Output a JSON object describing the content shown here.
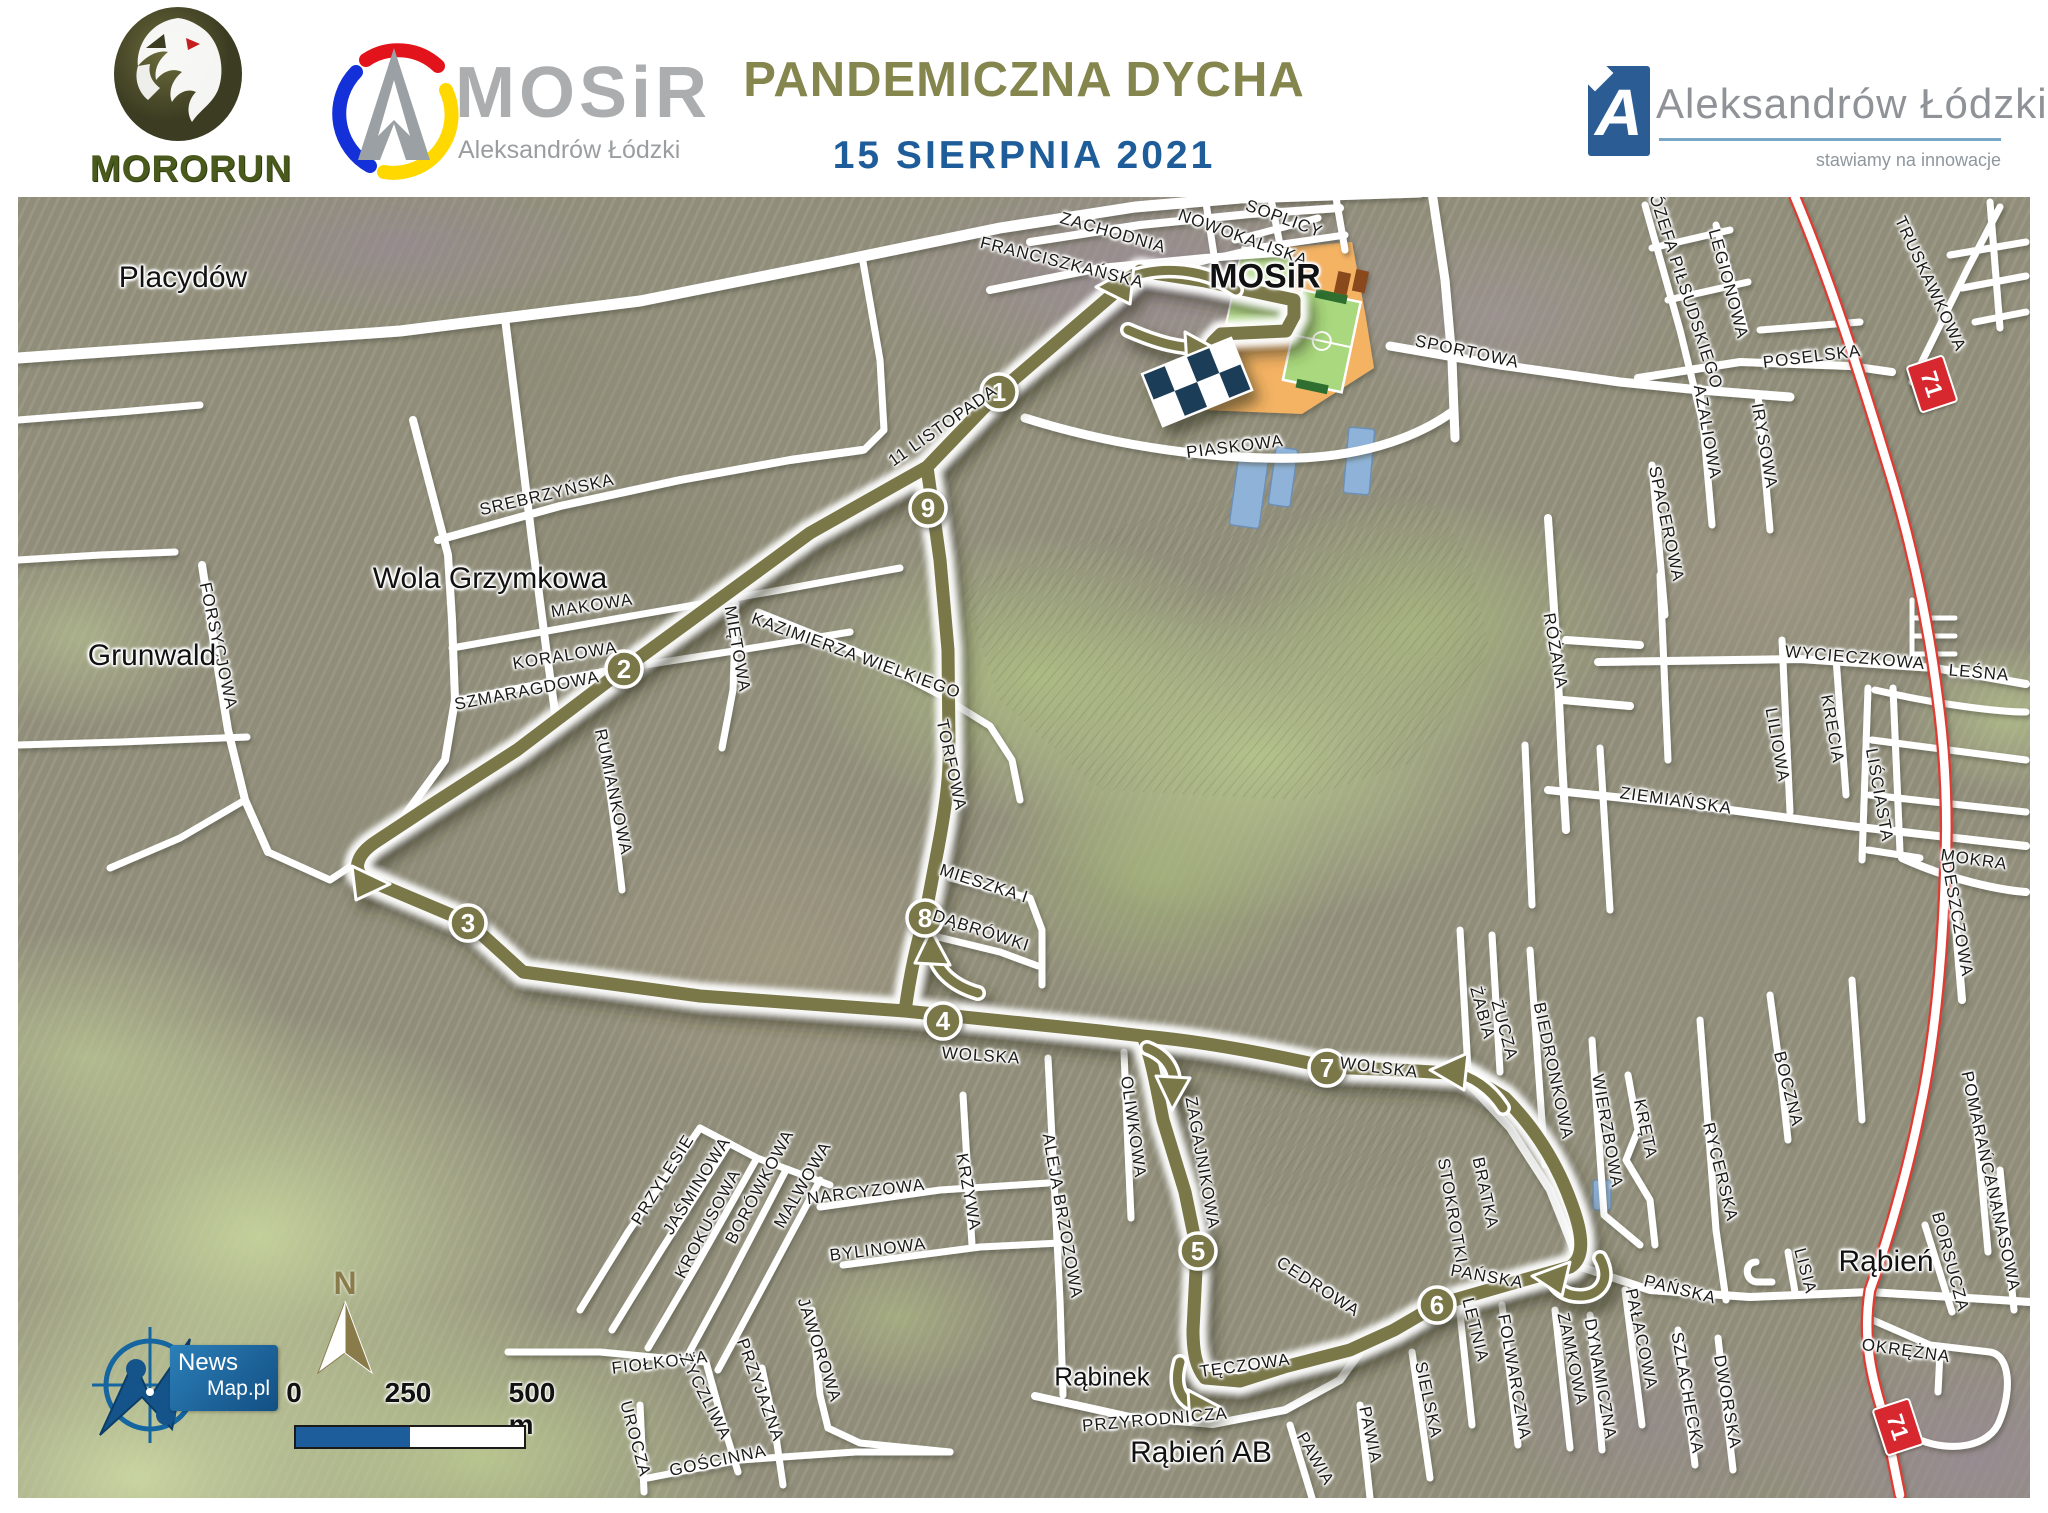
{
  "header": {
    "title": "PANDEMICZNA DYCHA",
    "date": "15 SIERPNIA 2021",
    "mororun_name": "MORORUN",
    "mosir_name": "MOSiR",
    "mosir_subtitle": "Aleksandrów Łódzki",
    "city_name": "Aleksandrów Łódzki",
    "city_tagline": "stawiamy na innowacje"
  },
  "map": {
    "places": [
      {
        "text": "Placydów",
        "x": 183,
        "y": 278,
        "s": 30
      },
      {
        "text": "Wola Grzymkowa",
        "x": 490,
        "y": 579,
        "s": 30
      },
      {
        "text": "Grunwald",
        "x": 152,
        "y": 656,
        "s": 30
      },
      {
        "text": "MOSiR",
        "x": 1265,
        "y": 277,
        "s": 34,
        "b": 1
      },
      {
        "text": "Rąbień",
        "x": 1886,
        "y": 1262,
        "s": 30
      },
      {
        "text": "Rąbinek",
        "x": 1102,
        "y": 1377,
        "s": 26
      },
      {
        "text": "Rąbień AB",
        "x": 1201,
        "y": 1453,
        "s": 30
      }
    ],
    "streets": [
      {
        "text": "ZACHODNIA",
        "x": 1113,
        "y": 233,
        "r": 16
      },
      {
        "text": "FRANCISZKAŃSKA",
        "x": 1062,
        "y": 263,
        "r": 14
      },
      {
        "text": "SOPLICY",
        "x": 1284,
        "y": 219,
        "r": 20
      },
      {
        "text": "NOWOKALISKA",
        "x": 1243,
        "y": 238,
        "r": 20
      },
      {
        "text": "SPORTOWA",
        "x": 1467,
        "y": 352,
        "r": 12
      },
      {
        "text": "PIASKOWA",
        "x": 1235,
        "y": 447,
        "r": -7
      },
      {
        "text": "11 LISTOPADA",
        "x": 943,
        "y": 426,
        "r": -35
      },
      {
        "text": "SREBRZYŃSKA",
        "x": 547,
        "y": 495,
        "r": -13
      },
      {
        "text": "MAKOWA",
        "x": 592,
        "y": 606,
        "r": -9
      },
      {
        "text": "KORALOWA",
        "x": 565,
        "y": 656,
        "r": -9
      },
      {
        "text": "SZMARAGDOWA",
        "x": 527,
        "y": 691,
        "r": -11
      },
      {
        "text": "MIĘTOWA",
        "x": 737,
        "y": 649,
        "r": 80
      },
      {
        "text": "KAZIMIERZA WIELKIEGO",
        "x": 856,
        "y": 656,
        "r": 20
      },
      {
        "text": "RUMIANKOWA",
        "x": 613,
        "y": 792,
        "r": 78
      },
      {
        "text": "FORSYCJOWA",
        "x": 218,
        "y": 646,
        "r": 78
      },
      {
        "text": "TORFOWA",
        "x": 951,
        "y": 765,
        "r": 78
      },
      {
        "text": "MIESZKA I",
        "x": 984,
        "y": 884,
        "r": 18
      },
      {
        "text": "DĄBRÓWKI",
        "x": 981,
        "y": 931,
        "r": 18
      },
      {
        "text": "WOLSKA",
        "x": 981,
        "y": 1056,
        "r": 4
      },
      {
        "text": "WOLSKA",
        "x": 1379,
        "y": 1068,
        "r": 7
      },
      {
        "text": "OLIWKOWA",
        "x": 1133,
        "y": 1127,
        "r": 82
      },
      {
        "text": "ZAGAJNIKOWA",
        "x": 1202,
        "y": 1163,
        "r": 80
      },
      {
        "text": "ALEJA BRZOZOWA",
        "x": 1062,
        "y": 1216,
        "r": 80
      },
      {
        "text": "CEDROWA",
        "x": 1318,
        "y": 1287,
        "r": 33
      },
      {
        "text": "STOKROTKI",
        "x": 1452,
        "y": 1211,
        "r": 80
      },
      {
        "text": "BRATKA",
        "x": 1485,
        "y": 1193,
        "r": 78
      },
      {
        "text": "ŻABIA",
        "x": 1482,
        "y": 1013,
        "r": 75
      },
      {
        "text": "ŻUCZA",
        "x": 1504,
        "y": 1030,
        "r": 75
      },
      {
        "text": "BIEDRONKOWA",
        "x": 1553,
        "y": 1071,
        "r": 78
      },
      {
        "text": "WIERZBOWA",
        "x": 1607,
        "y": 1131,
        "r": 80
      },
      {
        "text": "KRĘTA",
        "x": 1645,
        "y": 1129,
        "r": 78
      },
      {
        "text": "RYCERSKA",
        "x": 1720,
        "y": 1172,
        "r": 76
      },
      {
        "text": "BOCZNA",
        "x": 1788,
        "y": 1089,
        "r": 76
      },
      {
        "text": "LISIA",
        "x": 1805,
        "y": 1271,
        "r": 75
      },
      {
        "text": "PAŃSKA",
        "x": 1487,
        "y": 1277,
        "r": 10
      },
      {
        "text": "PAŃSKA",
        "x": 1680,
        "y": 1290,
        "r": 14
      },
      {
        "text": "LETNIA",
        "x": 1475,
        "y": 1330,
        "r": 76
      },
      {
        "text": "FOLWARCZNA",
        "x": 1514,
        "y": 1377,
        "r": 80
      },
      {
        "text": "ZAMKOWA",
        "x": 1572,
        "y": 1359,
        "r": 78
      },
      {
        "text": "DYNAMICZNA",
        "x": 1600,
        "y": 1379,
        "r": 80
      },
      {
        "text": "PAŁACOWA",
        "x": 1641,
        "y": 1339,
        "r": 78
      },
      {
        "text": "SZLACHECKA",
        "x": 1687,
        "y": 1393,
        "r": 80
      },
      {
        "text": "DWORSKA",
        "x": 1727,
        "y": 1402,
        "r": 80
      },
      {
        "text": "PRZYLESIE",
        "x": 663,
        "y": 1180,
        "r": -58
      },
      {
        "text": "JAŚMINOWA",
        "x": 697,
        "y": 1186,
        "r": -58
      },
      {
        "text": "KROKUSOWA",
        "x": 708,
        "y": 1224,
        "r": -62
      },
      {
        "text": "BORÓWKOWA",
        "x": 760,
        "y": 1187,
        "r": -62
      },
      {
        "text": "MALWOWA",
        "x": 803,
        "y": 1185,
        "r": -60
      },
      {
        "text": "NARCYZOWA",
        "x": 866,
        "y": 1192,
        "r": -7
      },
      {
        "text": "BYLINOWA",
        "x": 878,
        "y": 1250,
        "r": -7
      },
      {
        "text": "KRZYWA",
        "x": 968,
        "y": 1192,
        "r": 80
      },
      {
        "text": "JAWOROWA",
        "x": 819,
        "y": 1350,
        "r": 72
      },
      {
        "text": "FIOŁKOWA",
        "x": 660,
        "y": 1363,
        "r": -7
      },
      {
        "text": "ŻYCZLIWA",
        "x": 705,
        "y": 1397,
        "r": 63
      },
      {
        "text": "PRZYJAZNA",
        "x": 760,
        "y": 1390,
        "r": 70
      },
      {
        "text": "UROCZA",
        "x": 635,
        "y": 1439,
        "r": 75
      },
      {
        "text": "GOŚCINNA",
        "x": 718,
        "y": 1461,
        "r": -12
      },
      {
        "text": "PRZYRODNICZA",
        "x": 1155,
        "y": 1420,
        "r": -5
      },
      {
        "text": "TĘCZOWA",
        "x": 1245,
        "y": 1366,
        "r": -8
      },
      {
        "text": "PAWIA",
        "x": 1315,
        "y": 1459,
        "r": 60
      },
      {
        "text": "PAWIA",
        "x": 1370,
        "y": 1435,
        "r": 78
      },
      {
        "text": "SIELSKA",
        "x": 1428,
        "y": 1400,
        "r": 78
      },
      {
        "text": "ZIEMIAŃSKA",
        "x": 1676,
        "y": 801,
        "r": 8
      },
      {
        "text": "LILIOWA",
        "x": 1777,
        "y": 745,
        "r": 80
      },
      {
        "text": "KRECIA",
        "x": 1832,
        "y": 729,
        "r": 80
      },
      {
        "text": "LIŚCIASTA",
        "x": 1879,
        "y": 795,
        "r": 80
      },
      {
        "text": "WYCIECZKOWA",
        "x": 1855,
        "y": 658,
        "r": 5
      },
      {
        "text": "LEŚNA",
        "x": 1979,
        "y": 673,
        "r": 5
      },
      {
        "text": "MOKRA",
        "x": 1974,
        "y": 860,
        "r": 8
      },
      {
        "text": "DESZCZOWA",
        "x": 1957,
        "y": 919,
        "r": 80
      },
      {
        "text": "RÓŻANA",
        "x": 1555,
        "y": 651,
        "r": 80
      },
      {
        "text": "JÓZEFA PIŁSUDSKIEGO",
        "x": 1684,
        "y": 287,
        "r": 72
      },
      {
        "text": "LEGIONOWA",
        "x": 1728,
        "y": 284,
        "r": 75
      },
      {
        "text": "POSELSKA",
        "x": 1812,
        "y": 357,
        "r": -7
      },
      {
        "text": "AZALIOWA",
        "x": 1707,
        "y": 432,
        "r": 80
      },
      {
        "text": "IRYSOWA",
        "x": 1764,
        "y": 446,
        "r": 80
      },
      {
        "text": "SPACEROWA",
        "x": 1666,
        "y": 524,
        "r": 78
      },
      {
        "text": "TRUSKAWKOWA",
        "x": 1930,
        "y": 284,
        "r": 65
      },
      {
        "text": "POMARAŃCZOWA",
        "x": 1983,
        "y": 1150,
        "r": 78
      },
      {
        "text": "ANANASOWA",
        "x": 2002,
        "y": 1233,
        "r": 78
      },
      {
        "text": "BORSUCZA",
        "x": 1950,
        "y": 1262,
        "r": 75
      },
      {
        "text": "OKRĘŻNA",
        "x": 1906,
        "y": 1351,
        "r": 8
      }
    ],
    "km_markers": [
      {
        "n": "1",
        "x": 999,
        "y": 392
      },
      {
        "n": "2",
        "x": 624,
        "y": 669
      },
      {
        "n": "3",
        "x": 468,
        "y": 923
      },
      {
        "n": "4",
        "x": 943,
        "y": 1021
      },
      {
        "n": "5",
        "x": 1198,
        "y": 1251
      },
      {
        "n": "6",
        "x": 1437,
        "y": 1305
      },
      {
        "n": "7",
        "x": 1327,
        "y": 1068
      },
      {
        "n": "8",
        "x": 925,
        "y": 918
      },
      {
        "n": "9",
        "x": 928,
        "y": 508
      }
    ],
    "road_badges": [
      {
        "text": "71",
        "x": 1930,
        "y": 382,
        "r": 72
      },
      {
        "text": "71",
        "x": 1896,
        "y": 1425,
        "r": 72
      }
    ],
    "scale_ticks": [
      "0",
      "250",
      "500 m"
    ],
    "north_label": "N",
    "credit_line1": "News",
    "credit_line2": "Map.pl"
  },
  "colors": {
    "route": "#7a7749",
    "title": "#85854e",
    "date_blue": "#1e5d99",
    "badge_red": "#d7282f",
    "flag_navy": "#1c3c59",
    "scale_blue": "#1d5d9b"
  }
}
